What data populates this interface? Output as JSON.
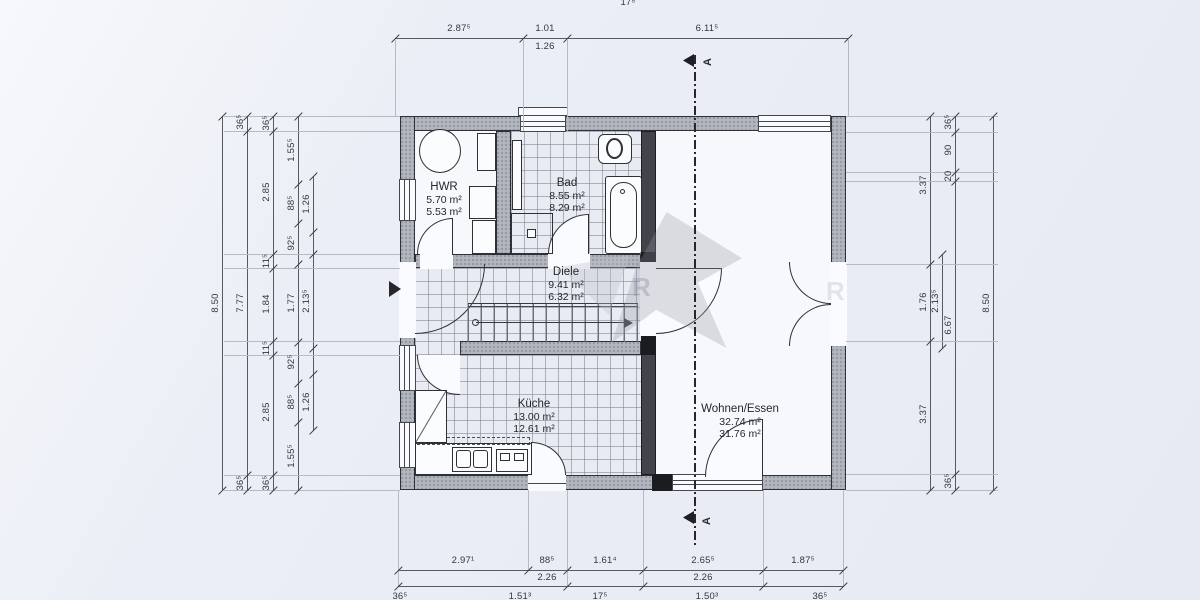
{
  "plan": {
    "type": "floor-plan",
    "section_marker": "A",
    "rooms": [
      {
        "name": "HWR",
        "area_gross": "5.70 m²",
        "area_net": "5.53 m²"
      },
      {
        "name": "Bad",
        "area_gross": "8.55 m²",
        "area_net": "8.29 m²"
      },
      {
        "name": "Diele",
        "area_gross": "9.41 m²",
        "area_net": "6.32 m²"
      },
      {
        "name": "Küche",
        "area_gross": "13.00 m²",
        "area_net": "12.61 m²"
      },
      {
        "name": "Wohnen/Essen",
        "area_gross": "32.74 m²",
        "area_net": "31.76 m²"
      }
    ],
    "watermark_letter": "R"
  },
  "dimensions": {
    "top_row1": [
      "2.87⁵",
      "1.01",
      "6.11⁵"
    ],
    "top_row2": [
      "1.26"
    ],
    "top_partial": "17⁵",
    "bottom_row1": [
      "2.97¹",
      "88⁵",
      "1.61⁴",
      "2.65⁵",
      "1.87⁵"
    ],
    "bottom_row2": [
      "2.26",
      "2.26"
    ],
    "bottom_row3_partial": [
      "36⁵",
      "1.51³",
      "17⁵",
      "1.50³",
      "36⁵"
    ],
    "left_col1": [
      "8.50"
    ],
    "left_col2": [
      "36⁵",
      "7.77",
      "36⁵"
    ],
    "left_col3": [
      "36⁵",
      "2.85",
      "11⁵",
      "1.84",
      "11⁵",
      "2.85",
      "36⁵"
    ],
    "left_col4": [
      "1.55⁵",
      "88⁵",
      "92⁵",
      "1.77",
      "92⁵",
      "88⁵",
      "1.55⁵"
    ],
    "left_col5": [
      "1.26",
      "2.13⁵",
      "1.26"
    ],
    "right_col1": [
      "3.37",
      "1.76",
      "3.37"
    ],
    "right_col2": [
      "2.13⁵"
    ],
    "right_col3": [
      "36⁵",
      "90",
      "20",
      "6.67",
      "36⁵"
    ],
    "right_col4": [
      "8.50"
    ]
  },
  "colors": {
    "paper": "#eaedf5",
    "wall_gray": "#b1b5be",
    "wall_dark": "#43444b",
    "tile_bg": "#e8ebf1",
    "tile_line": "#768092",
    "ink": "#2f3036"
  }
}
